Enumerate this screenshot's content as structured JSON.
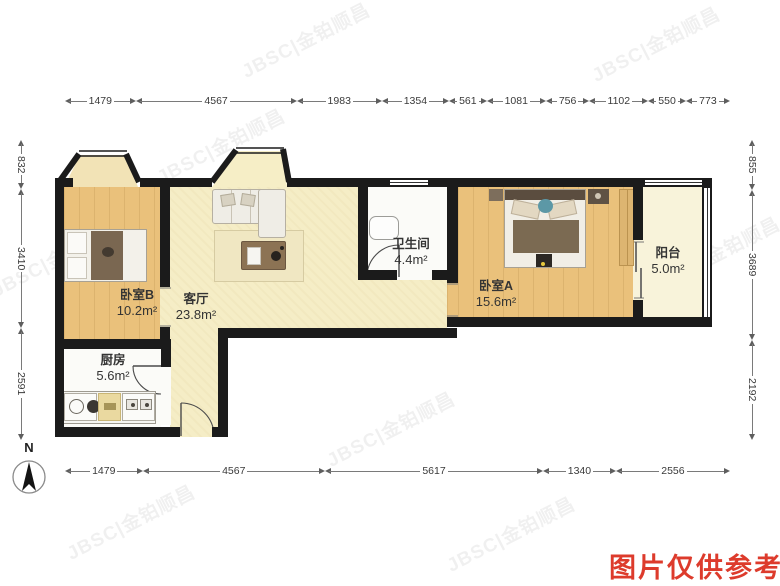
{
  "meta": {
    "caption": "图片仅供参考",
    "watermark": "JBSC|金铂顺昌",
    "north_label": "N"
  },
  "rooms": {
    "bedroom_b": {
      "name": "卧室B",
      "area": "10.2m²"
    },
    "living": {
      "name": "客厅",
      "area": "23.8m²"
    },
    "bathroom": {
      "name": "卫生间",
      "area": "4.4m²"
    },
    "bedroom_a": {
      "name": "卧室A",
      "area": "15.6m²"
    },
    "balcony": {
      "name": "阳台",
      "area": "5.0m²"
    },
    "kitchen": {
      "name": "厨房",
      "area": "5.6m²"
    }
  },
  "dimensions": {
    "top": [
      "1479",
      "4567",
      "1983",
      "1354",
      "561",
      "1081",
      "756",
      "1102",
      "550",
      "773"
    ],
    "bottom": [
      "1479",
      "4567",
      "5617",
      "1340",
      "2556"
    ],
    "left": [
      "832",
      "3410",
      "2591"
    ],
    "right": [
      "855",
      "3689",
      "2192"
    ]
  },
  "colors": {
    "wall": "#1b1b1b",
    "wood_floor": "#eac17b",
    "living_floor": "#f5edc6",
    "balcony_floor": "#f8f3da",
    "caption_red": "#dd3b2c"
  }
}
